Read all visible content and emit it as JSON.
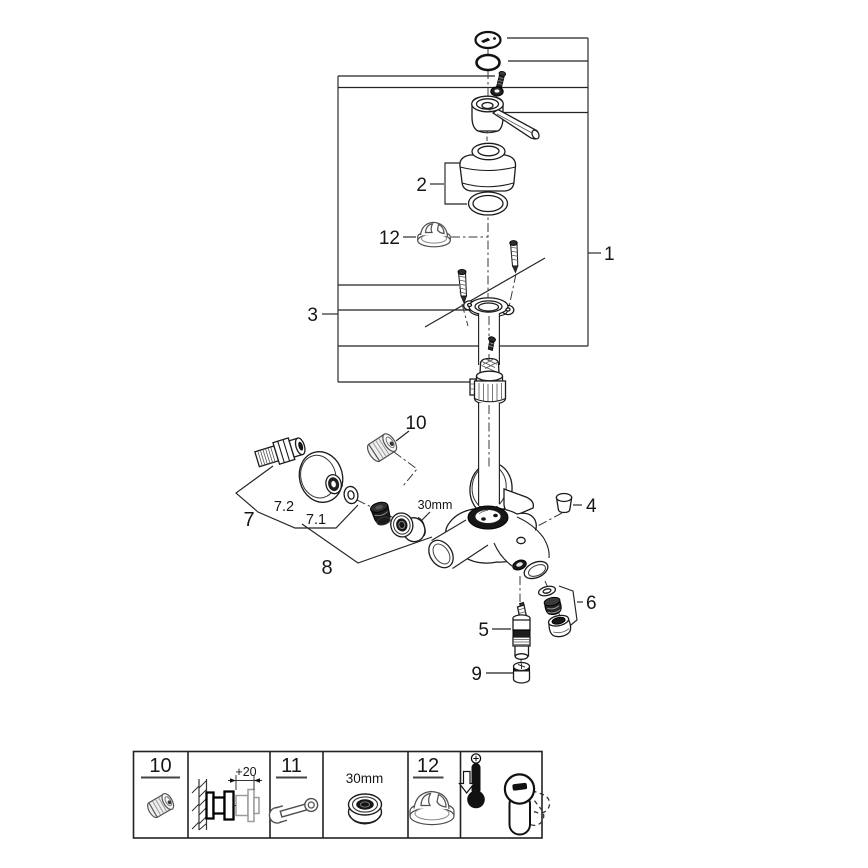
{
  "page": {
    "background": "#ffffff",
    "line_color": "#1c1c1c"
  },
  "callouts": {
    "item1": "1",
    "item2": "2",
    "item3": "3",
    "item4": "4",
    "item5": "5",
    "item6": "6",
    "item7": "7",
    "item7_1": "7.1",
    "item7_2": "7.2",
    "item8": "8",
    "item9": "9",
    "item10": "10",
    "item12": "12",
    "spout_nut_size": "30mm"
  },
  "legend": {
    "cell_10": {
      "number": "10",
      "icon": "extension-adapter-icon"
    },
    "cell_wall": {
      "dimension": "+20",
      "icon": "wall-extension-section-icon"
    },
    "cell_11": {
      "number": "11",
      "icon": "open-end-wrench-icon"
    },
    "cell_nut": {
      "size": "30mm",
      "icon": "hex-nut-icon"
    },
    "cell_12": {
      "number": "12",
      "icon": "temperature-limiter-cap-icon"
    },
    "cell_temp": {
      "icon": "temperature-adjust-handle-icon"
    }
  }
}
